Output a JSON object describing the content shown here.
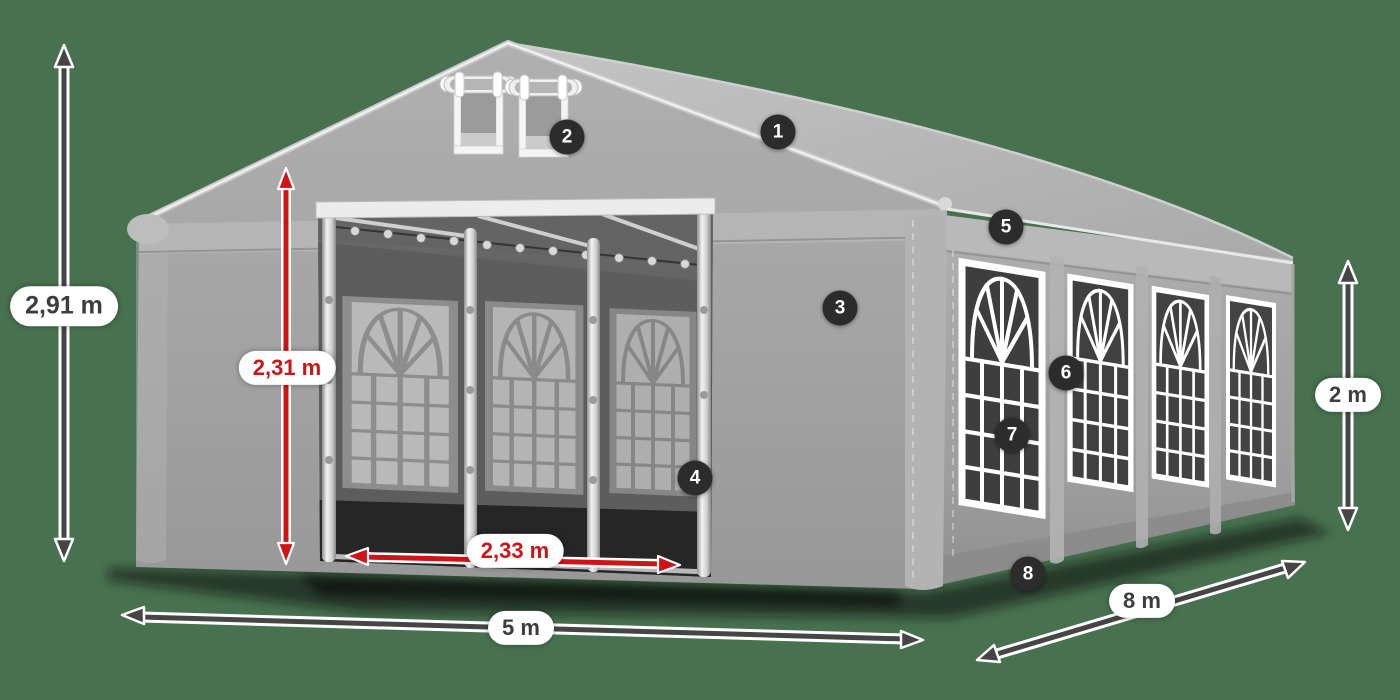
{
  "illustration": {
    "description": "Gray 5x8 m party tent with dimension arrows and numbered feature hotspots",
    "background_color": "#47714F"
  },
  "colors": {
    "accent_red": "#CE1417",
    "label_dark": "#3D3D3D",
    "badge_background": "#2C2C2C",
    "tent_canvas": "#A6A6A6"
  },
  "dimension_labels": {
    "total_height": "2,91 m",
    "door_height": "2,31 m",
    "door_width": "2,33 m",
    "front_width": "5 m",
    "side_length": "8 m",
    "wall_height": "2 m"
  },
  "feature_badges": [
    {
      "number": "1"
    },
    {
      "number": "2"
    },
    {
      "number": "3"
    },
    {
      "number": "4"
    },
    {
      "number": "5"
    },
    {
      "number": "6"
    },
    {
      "number": "7"
    },
    {
      "number": "8"
    }
  ]
}
